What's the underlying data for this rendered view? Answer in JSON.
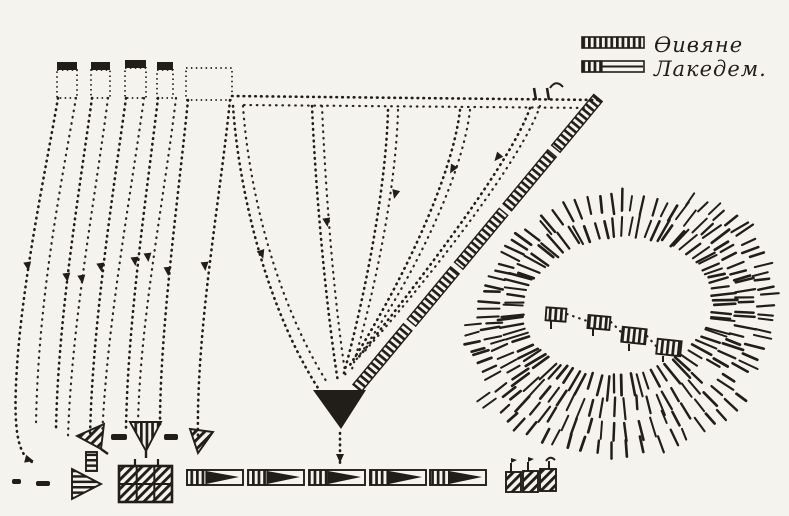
{
  "figure": {
    "kind": "scanned hand-drawn battle movement diagram",
    "paper_color": "#f5f3ee",
    "ink_color": "#211e19"
  },
  "legend": {
    "items": [
      {
        "id": "thebans",
        "symbol": "full-hatched-bar",
        "label": "Ѳивяне"
      },
      {
        "id": "lacedaemonians",
        "symbol": "half-hatched-bar",
        "label": "Лакедем."
      }
    ]
  },
  "map_symbols": {
    "diagonal_hatched_bar": "Theban battle line",
    "dotted_curves": "march routes with direction arrowheads",
    "black_triangle": "deep attack column",
    "hachured_ring": "hill",
    "hill_blocks": "units on hill",
    "bottom_wedges": "deployed line units",
    "hatched_triangles_and_grid": "reserve / cavalry unit symbols"
  }
}
